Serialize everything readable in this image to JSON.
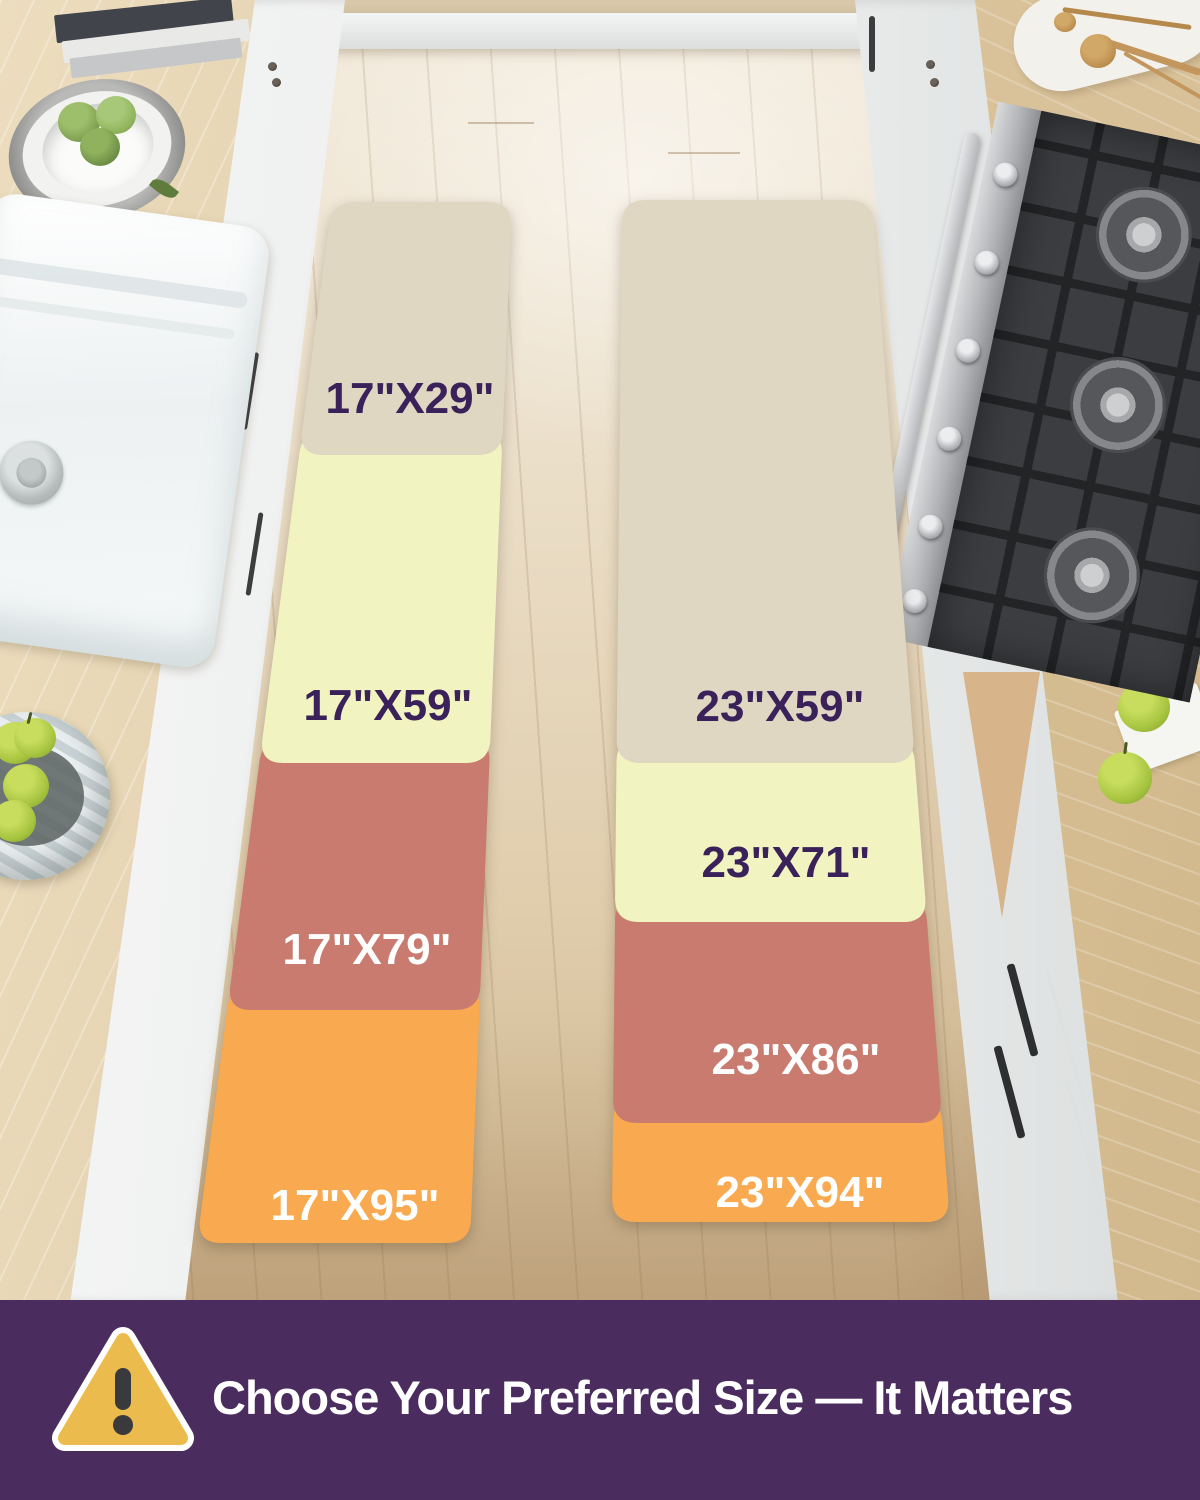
{
  "runners": {
    "narrow": {
      "name": "17 inch wide runner set",
      "sizes": [
        {
          "label": "17\"X29\"",
          "color": "#DFD7C1",
          "text_color": "#3A2159"
        },
        {
          "label": "17\"X59\"",
          "color": "#F1F4C0",
          "text_color": "#3A2159"
        },
        {
          "label": "17\"X79\"",
          "color": "#C87B6E",
          "text_color": "#FFFFFF"
        },
        {
          "label": "17\"X95\"",
          "color": "#F9A94F",
          "text_color": "#FFFFFF"
        }
      ]
    },
    "wide": {
      "name": "23 inch wide runner set",
      "sizes": [
        {
          "label": "23\"X59\"",
          "color": "#DFD7C1",
          "text_color": "#3A2159"
        },
        {
          "label": "23\"X71\"",
          "color": "#F1F4C0",
          "text_color": "#3A2159"
        },
        {
          "label": "23\"X86\"",
          "color": "#C87B6E",
          "text_color": "#FFFFFF"
        },
        {
          "label": "23\"X94\"",
          "color": "#F9A94F",
          "text_color": "#FFFFFF"
        }
      ]
    }
  },
  "banner": {
    "text": "Choose Your Preferred Size — It Matters",
    "background_color": "#4A2C5E",
    "text_color": "#FFFFFF",
    "icon": "warning-triangle-icon",
    "icon_color": "#ECBB4D",
    "icon_mark_color": "#3A3A3C"
  }
}
